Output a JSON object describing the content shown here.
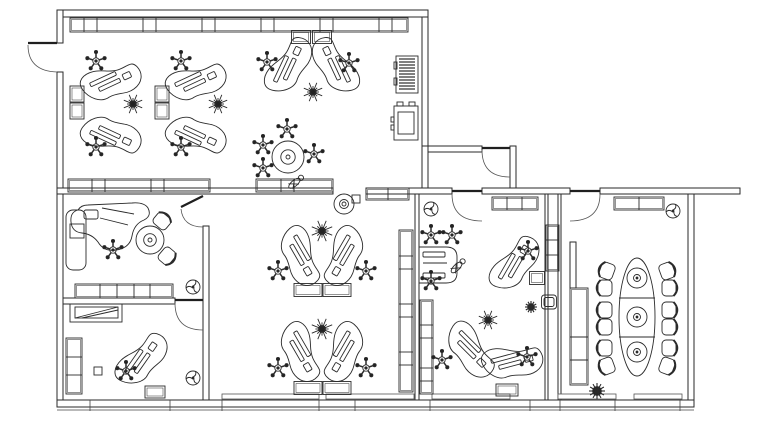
{
  "drawing": {
    "kind": "office-floor-plan",
    "canvas": {
      "width": 768,
      "height": 424,
      "background": "#ffffff",
      "line_color": "#2b2b2b"
    },
    "walls": [
      [
        57,
        10,
        371,
        7
      ],
      [
        57,
        10,
        6,
        33
      ],
      [
        57,
        72,
        6,
        335
      ],
      [
        422,
        17,
        6,
        129
      ],
      [
        422,
        146,
        60,
        6
      ],
      [
        510,
        146,
        6,
        48
      ],
      [
        422,
        146,
        6,
        48
      ],
      [
        57,
        188,
        276,
        6
      ],
      [
        366,
        188,
        86,
        6
      ],
      [
        482,
        188,
        88,
        6
      ],
      [
        600,
        188,
        140,
        6
      ],
      [
        688,
        194,
        6,
        213
      ],
      [
        57,
        400,
        637,
        7
      ],
      [
        203,
        226,
        6,
        174
      ],
      [
        63,
        298,
        112,
        6
      ],
      [
        415,
        194,
        4,
        206
      ],
      [
        545,
        194,
        3,
        206
      ],
      [
        558,
        194,
        3,
        206
      ],
      [
        570,
        242,
        6,
        46
      ]
    ],
    "doors": [
      {
        "name": "exterior-door-left",
        "leaf": [
          28,
          43,
          57,
          43
        ],
        "arc": "M28,45 Q28,71 57,72"
      },
      {
        "name": "entry-door",
        "leaf": [
          482,
          148,
          510,
          148
        ],
        "arc": "M482,150 Q482,177 510,177"
      },
      {
        "name": "vestibule-office-door",
        "leaf": [
          452,
          191,
          482,
          191
        ],
        "arc": "M452,194 Q452,221 482,221"
      },
      {
        "name": "conference-door",
        "leaf": [
          570,
          191,
          600,
          191
        ],
        "arc": "M600,194 Q600,221 570,221"
      },
      {
        "name": "lower-left-room-door",
        "leaf": [
          175,
          300,
          203,
          300
        ],
        "arc": "M175,303 Q175,330 203,330"
      },
      {
        "name": "middle-left-room-door",
        "leaf": [
          203,
          196,
          181,
          207
        ],
        "arc": "M181,209 Q183,227 203,227"
      }
    ],
    "window_sills": [
      [
        222,
        394,
        97,
        5
      ],
      [
        326,
        394,
        88,
        5
      ],
      [
        432,
        394,
        78,
        5
      ],
      [
        558,
        394,
        58,
        5
      ],
      [
        634,
        394,
        48,
        5
      ]
    ],
    "base_line": [
      57,
      410,
      694,
      410
    ],
    "base_ticks": [
      90,
      170,
      222,
      319,
      355,
      430,
      530,
      560,
      615,
      680
    ],
    "cabinets": [
      {
        "x": 70,
        "y": 18,
        "w": 338,
        "h": 14,
        "div": [
          84,
          97,
          143,
          156,
          202,
          215,
          261,
          274,
          320,
          333,
          379,
          392
        ]
      },
      {
        "x": 68,
        "y": 179,
        "w": 142,
        "h": 13,
        "div": [
          92,
          105,
          151,
          164
        ]
      },
      {
        "x": 256,
        "y": 179,
        "w": 77,
        "h": 13,
        "div": [
          281,
          294
        ]
      },
      {
        "x": 366,
        "y": 188,
        "w": 43,
        "h": 12,
        "div": [
          388
        ]
      },
      {
        "x": 492,
        "y": 197,
        "w": 46,
        "h": 13,
        "div": [
          507,
          522
        ]
      },
      {
        "x": 614,
        "y": 197,
        "w": 50,
        "h": 13,
        "div": [
          639
        ]
      },
      {
        "x": 75,
        "y": 284,
        "w": 98,
        "h": 14,
        "div": [
          100,
          117,
          134,
          150
        ]
      },
      {
        "x": 399,
        "y": 230,
        "w": 14,
        "h": 162,
        "div": [
          256,
          269,
          304,
          317,
          352,
          365
        ]
      },
      {
        "x": 420,
        "y": 300,
        "w": 13,
        "h": 94,
        "div": [
          325,
          338,
          368,
          381
        ]
      },
      {
        "x": 546,
        "y": 225,
        "w": 13,
        "h": 46,
        "div": [
          240,
          255
        ]
      },
      {
        "x": 570,
        "y": 288,
        "w": 18,
        "h": 97,
        "div": [
          337,
          360
        ]
      },
      {
        "x": 66,
        "y": 338,
        "w": 16,
        "h": 56,
        "div": [
          357,
          375
        ]
      }
    ],
    "furniture": [
      {
        "t": "desk",
        "x": 111,
        "y": 82,
        "r": -25
      },
      {
        "t": "desk",
        "x": 111,
        "y": 135,
        "r": 25,
        "f": "y"
      },
      {
        "t": "chair",
        "x": 96,
        "y": 61
      },
      {
        "t": "chair",
        "x": 96,
        "y": 147
      },
      {
        "t": "plant",
        "x": 133,
        "y": 104,
        "s": 10
      },
      {
        "t": "ped",
        "x": 77,
        "y": 94,
        "w": 14,
        "h": 16
      },
      {
        "t": "ped",
        "x": 77,
        "y": 111,
        "w": 14,
        "h": 16
      },
      {
        "t": "desk",
        "x": 196,
        "y": 82,
        "r": -25
      },
      {
        "t": "desk",
        "x": 196,
        "y": 135,
        "r": 25,
        "f": "y"
      },
      {
        "t": "chair",
        "x": 181,
        "y": 61
      },
      {
        "t": "chair",
        "x": 181,
        "y": 147
      },
      {
        "t": "plant",
        "x": 218,
        "y": 104,
        "s": 10
      },
      {
        "t": "ped",
        "x": 162,
        "y": 94,
        "w": 14,
        "h": 16
      },
      {
        "t": "ped",
        "x": 162,
        "y": 111,
        "w": 14,
        "h": 16
      },
      {
        "t": "desk",
        "x": 289,
        "y": 66,
        "r": -65
      },
      {
        "t": "desk",
        "x": 335,
        "y": 66,
        "r": 65,
        "f": "x"
      },
      {
        "t": "chair",
        "x": 267,
        "y": 62
      },
      {
        "t": "chair",
        "x": 349,
        "y": 63
      },
      {
        "t": "plant",
        "x": 313,
        "y": 92,
        "s": 10
      },
      {
        "t": "ped",
        "x": 301,
        "y": 37,
        "w": 19,
        "h": 13
      },
      {
        "t": "ped",
        "x": 322,
        "y": 37,
        "w": 19,
        "h": 13
      },
      {
        "t": "rtable",
        "x": 288,
        "y": 157,
        "s": 16
      },
      {
        "t": "chair",
        "x": 287,
        "y": 129
      },
      {
        "t": "chair",
        "x": 263,
        "y": 145
      },
      {
        "t": "chair",
        "x": 263,
        "y": 168
      },
      {
        "t": "chair",
        "x": 314,
        "y": 154
      },
      {
        "t": "person",
        "x": 296,
        "y": 182,
        "r": -40
      },
      {
        "t": "shelf",
        "x": 407,
        "y": 74
      },
      {
        "t": "copier",
        "x": 406,
        "y": 123
      },
      {
        "t": "rtable",
        "x": 344,
        "y": 204,
        "s": 10
      },
      {
        "t": "sq",
        "x": 356,
        "y": 199,
        "w": 8,
        "h": 8
      },
      {
        "t": "desk",
        "x": 300,
        "y": 256,
        "r": 60
      },
      {
        "t": "desk",
        "x": 344,
        "y": 256,
        "r": -60,
        "f": "x"
      },
      {
        "t": "plant",
        "x": 322,
        "y": 231,
        "s": 11
      },
      {
        "t": "chair",
        "x": 278,
        "y": 271
      },
      {
        "t": "chair",
        "x": 366,
        "y": 271
      },
      {
        "t": "ped",
        "x": 308,
        "y": 290,
        "w": 28,
        "h": 13
      },
      {
        "t": "ped",
        "x": 337,
        "y": 290,
        "w": 28,
        "h": 13
      },
      {
        "t": "desk",
        "x": 300,
        "y": 352,
        "r": 60
      },
      {
        "t": "desk",
        "x": 344,
        "y": 352,
        "r": -60,
        "f": "x"
      },
      {
        "t": "plant",
        "x": 322,
        "y": 329,
        "s": 11
      },
      {
        "t": "chair",
        "x": 278,
        "y": 368
      },
      {
        "t": "chair",
        "x": 366,
        "y": 368
      },
      {
        "t": "ped",
        "x": 308,
        "y": 388,
        "w": 28,
        "h": 13
      },
      {
        "t": "ped",
        "x": 337,
        "y": 388,
        "w": 28,
        "h": 13
      },
      {
        "t": "blobdesk",
        "x": 108,
        "y": 232
      },
      {
        "t": "annex",
        "x": 76,
        "y": 240,
        "w": 20,
        "h": 60
      },
      {
        "t": "sq",
        "x": 77,
        "y": 231,
        "w": 14,
        "h": 14
      },
      {
        "t": "chair",
        "x": 113,
        "y": 250
      },
      {
        "t": "rtable",
        "x": 150,
        "y": 240,
        "s": 14
      },
      {
        "t": "armchair",
        "x": 162,
        "y": 221,
        "r": 40
      },
      {
        "t": "armchair",
        "x": 167,
        "y": 256,
        "r": 130
      },
      {
        "t": "fan",
        "x": 193,
        "y": 287
      },
      {
        "t": "sidetable",
        "x": 96,
        "y": 313
      },
      {
        "t": "desk",
        "x": 142,
        "y": 360,
        "r": -55
      },
      {
        "t": "chair",
        "x": 126,
        "y": 371
      },
      {
        "t": "ped",
        "x": 155,
        "y": 392,
        "w": 20,
        "h": 12
      },
      {
        "t": "sq",
        "x": 98,
        "y": 371,
        "w": 8,
        "h": 8
      },
      {
        "t": "fan",
        "x": 193,
        "y": 378
      },
      {
        "t": "fan",
        "x": 431,
        "y": 209
      },
      {
        "t": "chair",
        "x": 431,
        "y": 235
      },
      {
        "t": "chair",
        "x": 452,
        "y": 235
      },
      {
        "t": "rectdesk",
        "x": 438,
        "y": 265
      },
      {
        "t": "chair",
        "x": 431,
        "y": 281
      },
      {
        "t": "person",
        "x": 458,
        "y": 266,
        "r": -45
      },
      {
        "t": "desk",
        "x": 515,
        "y": 264,
        "r": -60
      },
      {
        "t": "chair",
        "x": 528,
        "y": 251
      },
      {
        "t": "ped",
        "x": 537,
        "y": 278,
        "w": 15,
        "h": 13
      },
      {
        "t": "bush",
        "x": 531,
        "y": 307
      },
      {
        "t": "stool",
        "x": 549,
        "y": 302
      },
      {
        "t": "plant",
        "x": 488,
        "y": 320,
        "s": 10
      },
      {
        "t": "desk",
        "x": 470,
        "y": 350,
        "r": 45
      },
      {
        "t": "desk",
        "x": 512,
        "y": 362,
        "r": -15
      },
      {
        "t": "chair",
        "x": 442,
        "y": 360
      },
      {
        "t": "chair",
        "x": 527,
        "y": 357
      },
      {
        "t": "ped",
        "x": 507,
        "y": 390,
        "w": 22,
        "h": 12
      },
      {
        "t": "fan",
        "x": 673,
        "y": 211
      },
      {
        "t": "ctable",
        "x": 637,
        "y": 317
      },
      {
        "t": "armchair",
        "x": 607,
        "y": 271,
        "r": -70
      },
      {
        "t": "armchair",
        "x": 605,
        "y": 288,
        "r": -90
      },
      {
        "t": "armchair",
        "x": 605,
        "y": 310,
        "r": -90
      },
      {
        "t": "armchair",
        "x": 605,
        "y": 327,
        "r": -90
      },
      {
        "t": "armchair",
        "x": 605,
        "y": 348,
        "r": -90
      },
      {
        "t": "armchair",
        "x": 607,
        "y": 366,
        "r": -110
      },
      {
        "t": "armchair",
        "x": 667,
        "y": 271,
        "r": 70
      },
      {
        "t": "armchair",
        "x": 669,
        "y": 288,
        "r": 90
      },
      {
        "t": "armchair",
        "x": 669,
        "y": 310,
        "r": 90
      },
      {
        "t": "armchair",
        "x": 669,
        "y": 327,
        "r": 90
      },
      {
        "t": "armchair",
        "x": 669,
        "y": 348,
        "r": 90
      },
      {
        "t": "armchair",
        "x": 667,
        "y": 366,
        "r": 110
      },
      {
        "t": "bush",
        "x": 597,
        "y": 391,
        "s": 8
      }
    ]
  }
}
